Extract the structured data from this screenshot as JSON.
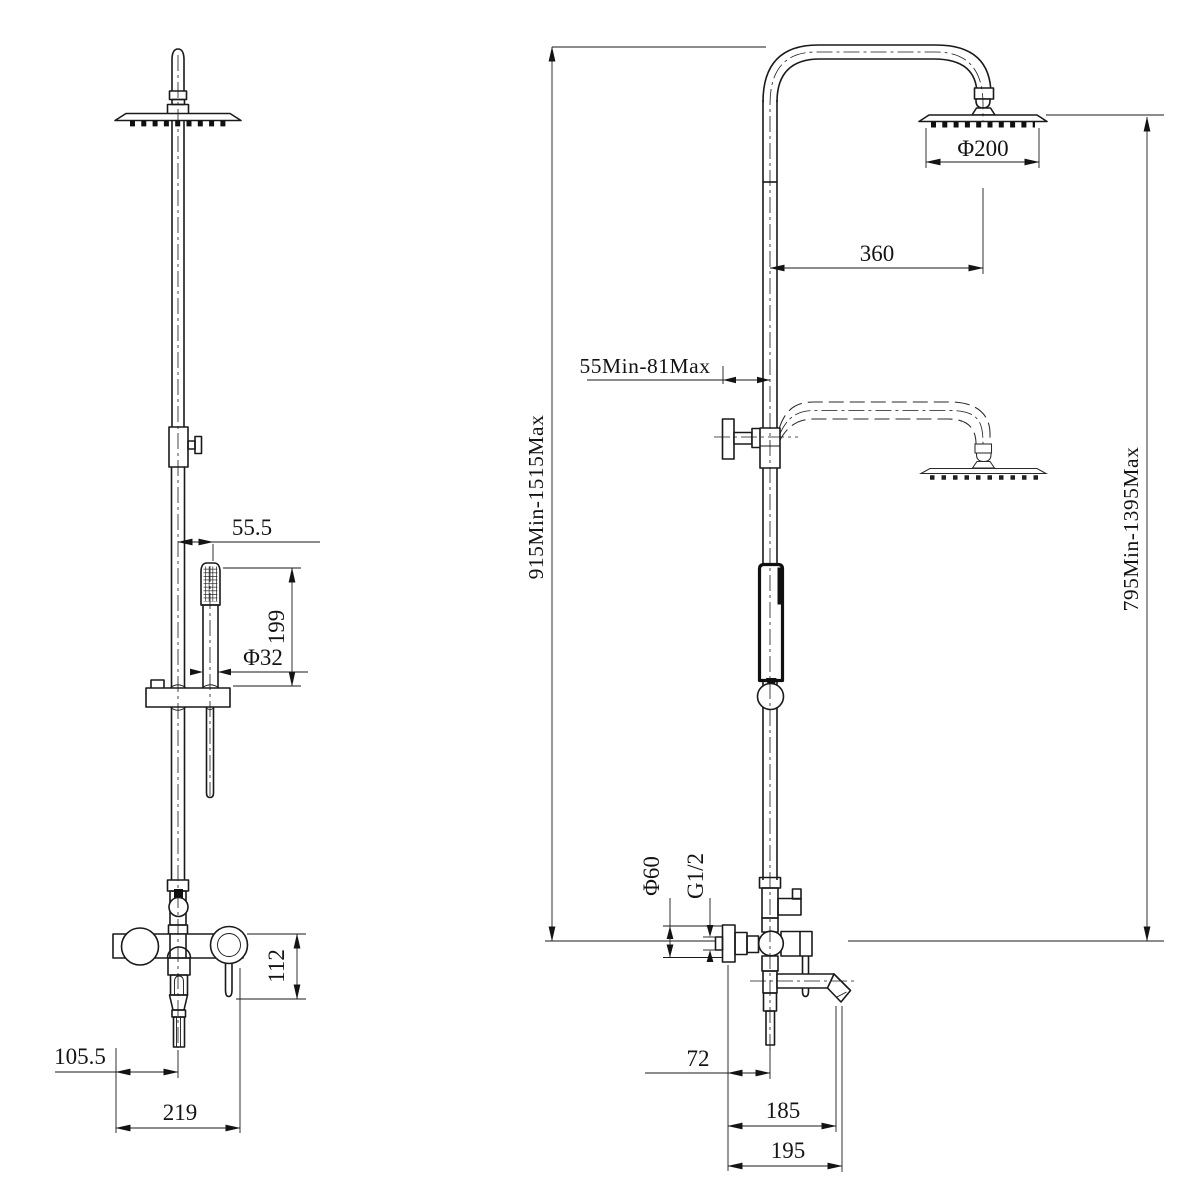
{
  "dimensions": {
    "front": {
      "hand_shower_offset": "55.5",
      "hand_shower_length": "199",
      "hand_shower_diameter": "Φ32",
      "mixer_body_height": "112",
      "spout_center_offset": "105.5",
      "mixer_body_width": "219"
    },
    "side": {
      "shower_head_diameter": "Φ200",
      "arm_reach": "360",
      "wall_bracket_range": "55Min-81Max",
      "riser_height_range": "915Min-1515Max",
      "head_height_range": "795Min-1395Max",
      "escutcheon_diameter": "Φ60",
      "connection_thread": "G1/2",
      "outlet_offset": "72",
      "spout_reach": "185",
      "spout_overall_reach": "195"
    }
  }
}
